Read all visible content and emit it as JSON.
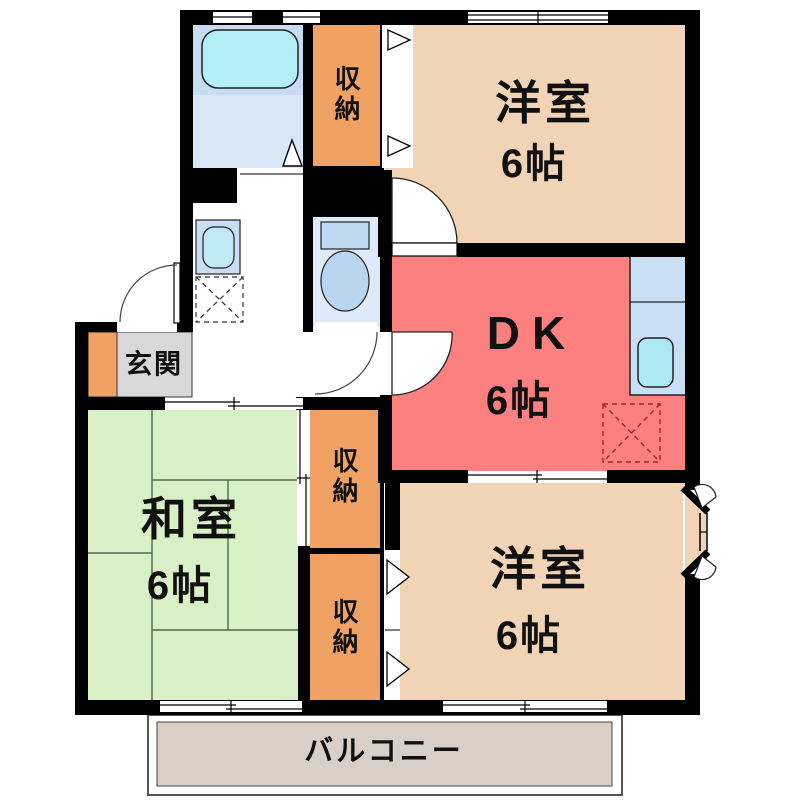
{
  "plan_title": "2DK apartment floor plan",
  "rooms": {
    "western_top": {
      "name": "洋室",
      "size": "6帖"
    },
    "dk": {
      "name": "DK",
      "size": "6帖"
    },
    "western_bottom": {
      "name": "洋室",
      "size": "6帖"
    },
    "japanese_room": {
      "name": "和室",
      "size": "6帖"
    },
    "entrance": {
      "name": "玄関"
    },
    "balcony": {
      "name": "バルコニー"
    },
    "closet_top": {
      "name": "収納"
    },
    "closet_middle": {
      "name": "収納"
    },
    "closet_bottom": {
      "name": "収納"
    }
  },
  "colors": {
    "wall": "#000000",
    "western_room": "#F1D3B5",
    "dk": "#FC8080",
    "japanese_room": "#D9F0C7",
    "closet": "#F0A264",
    "entrance_floor": "#D8D8D8",
    "entrance_cabinet": "#F0A264",
    "balcony_floor": "#D9CFC6",
    "bathroom_floor": "#D8E6F6",
    "bathtub": "#B3EEF7",
    "fixture_blue": "#C9DFF5",
    "tatami_line": "#4a6a4a"
  }
}
